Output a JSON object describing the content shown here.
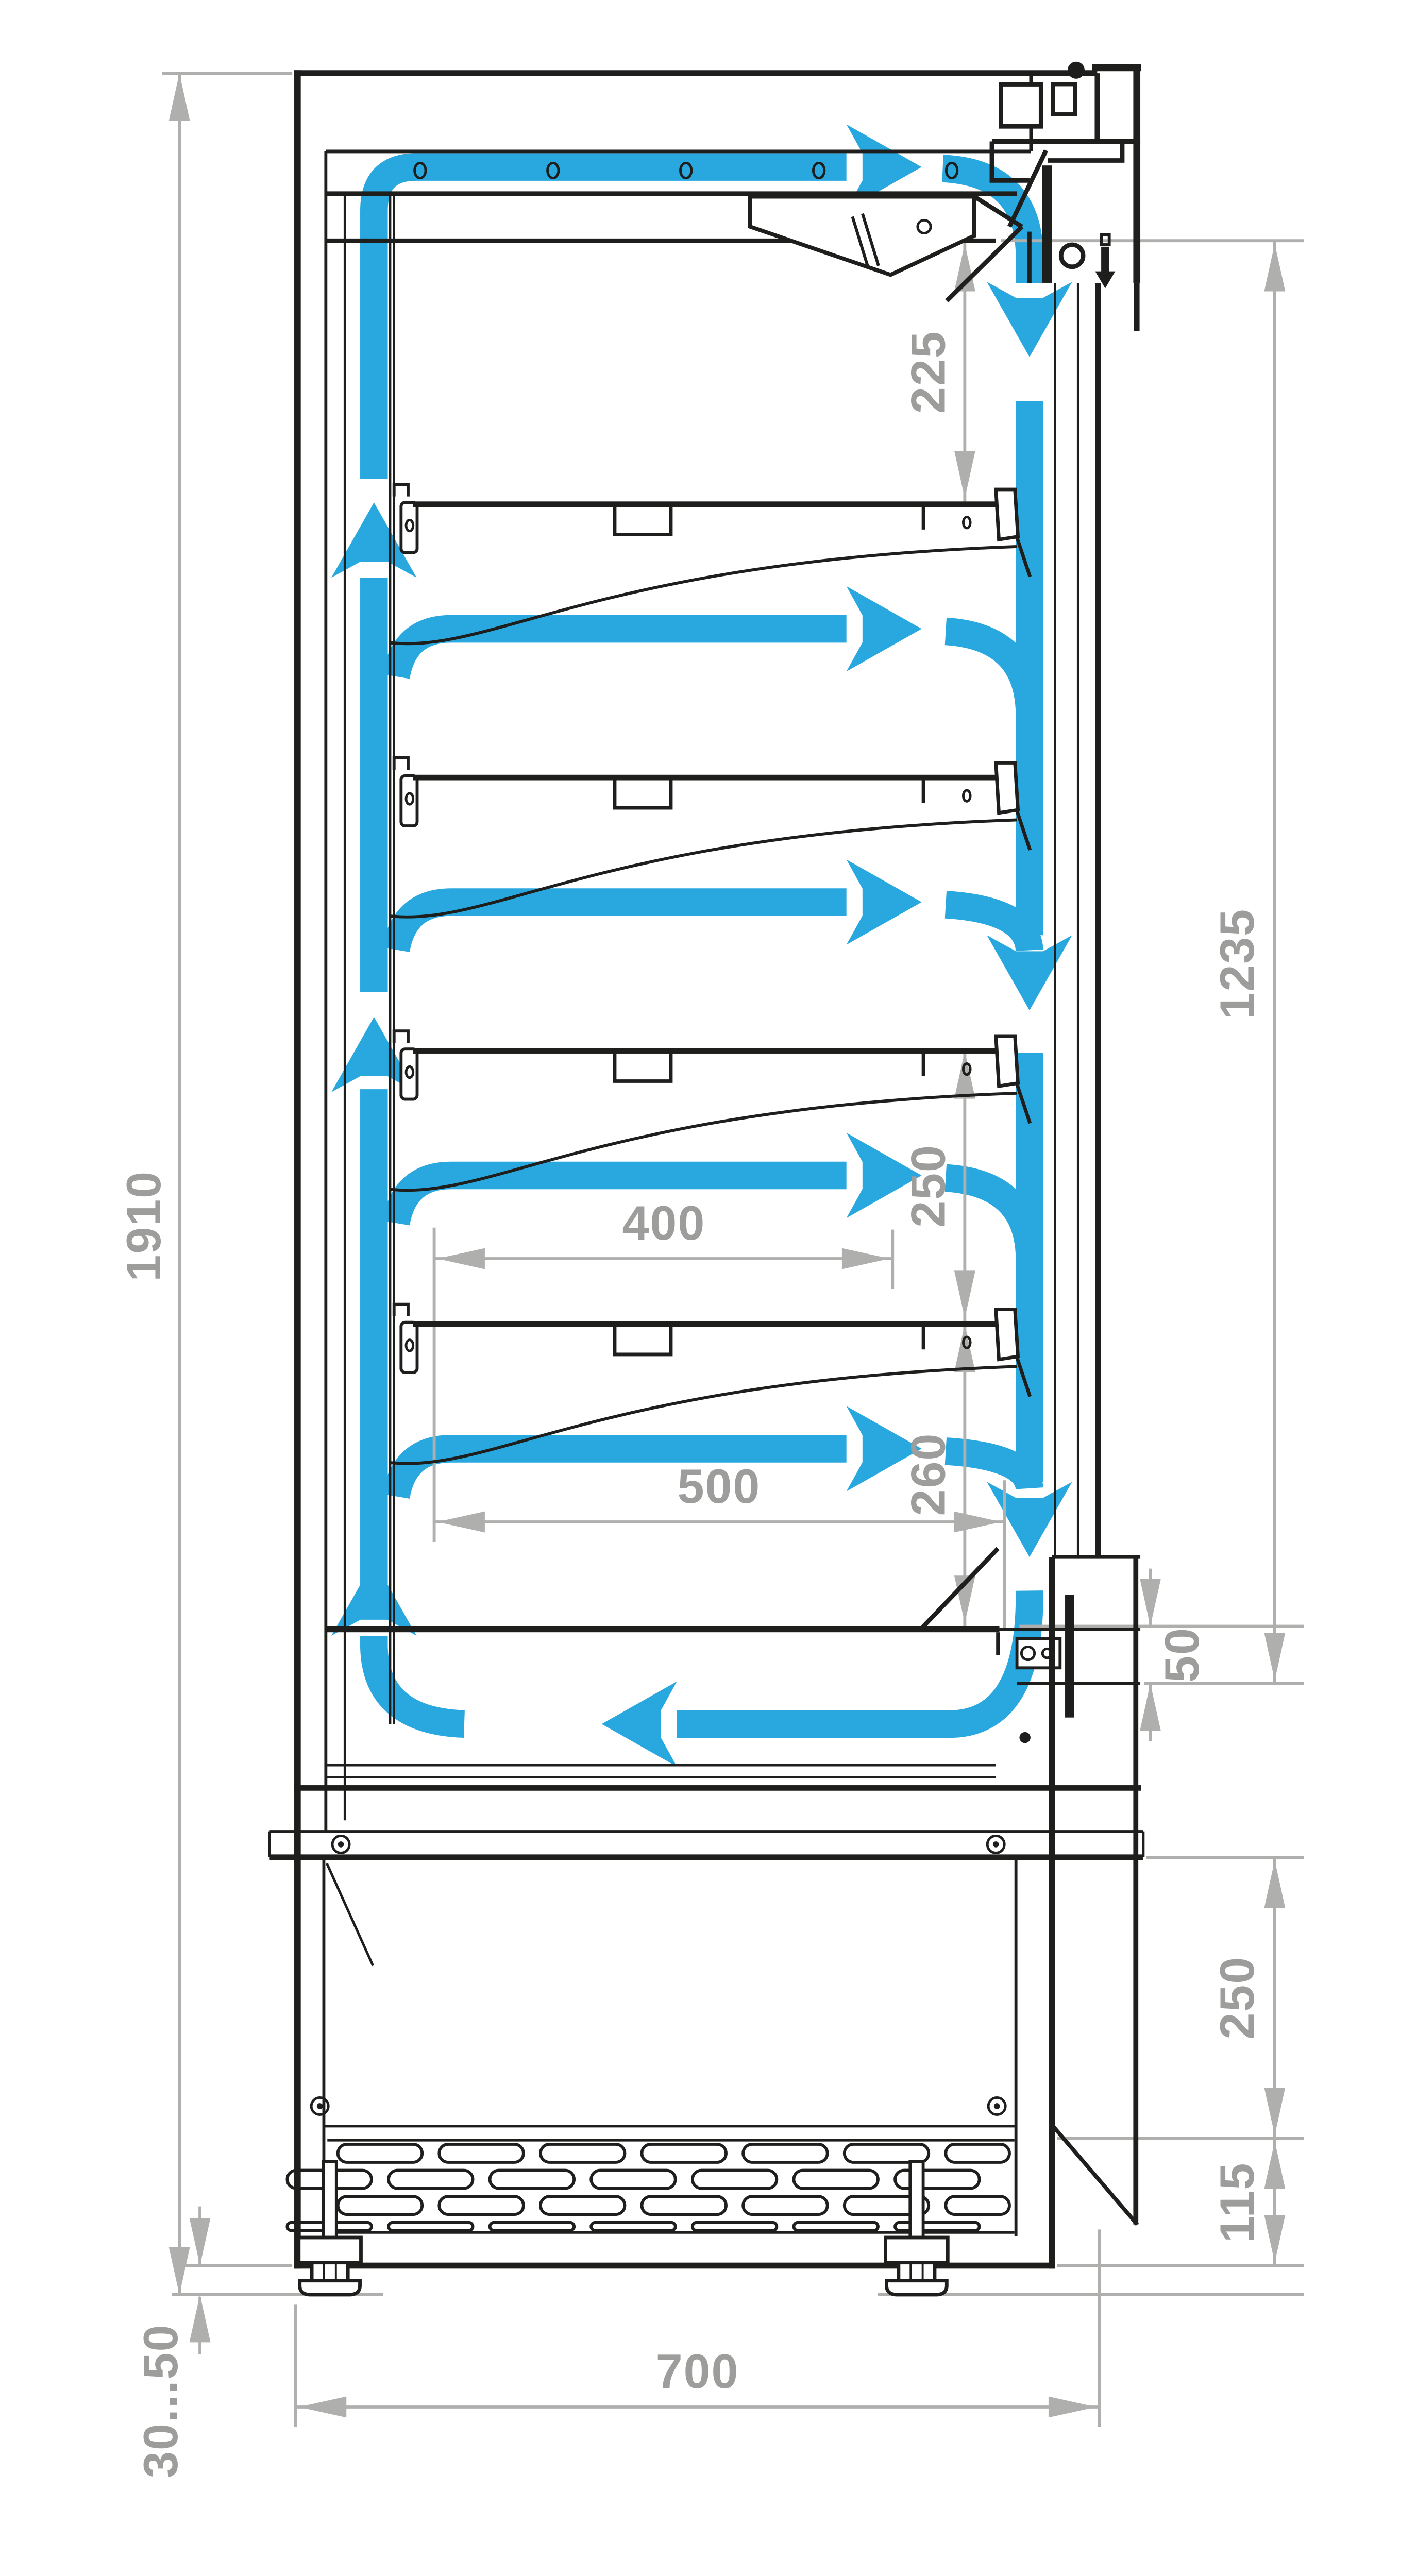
{
  "diagram": {
    "kind": "refrigerated-multideck-display-cabinet-cross-section",
    "dims": {
      "overall_height": "1910",
      "canopy_to_first_shelf": "225",
      "air_curtain_drop": "1235",
      "shelf_spacing": "250",
      "shelf_depth": "400",
      "shelf_to_deck": "260",
      "deck_depth": "500",
      "curtain_gap": "50",
      "machine_compartment_height": "250",
      "louver_height": "115",
      "foot_adjustment": "30...50",
      "overall_depth": "700"
    },
    "colors": {
      "airflow": "#29A8E0",
      "dimension_line": "#AFAFAE",
      "dimension_text": "#9D9D9C",
      "outline": "#1E1E1C",
      "background": "#FFFFFF"
    },
    "airflow_icons": [
      "riser-duct-up-arrow",
      "top-supply-arrow",
      "shelf-supply-arrow",
      "air-curtain-down-arrow",
      "return-air-left-arrow"
    ]
  }
}
